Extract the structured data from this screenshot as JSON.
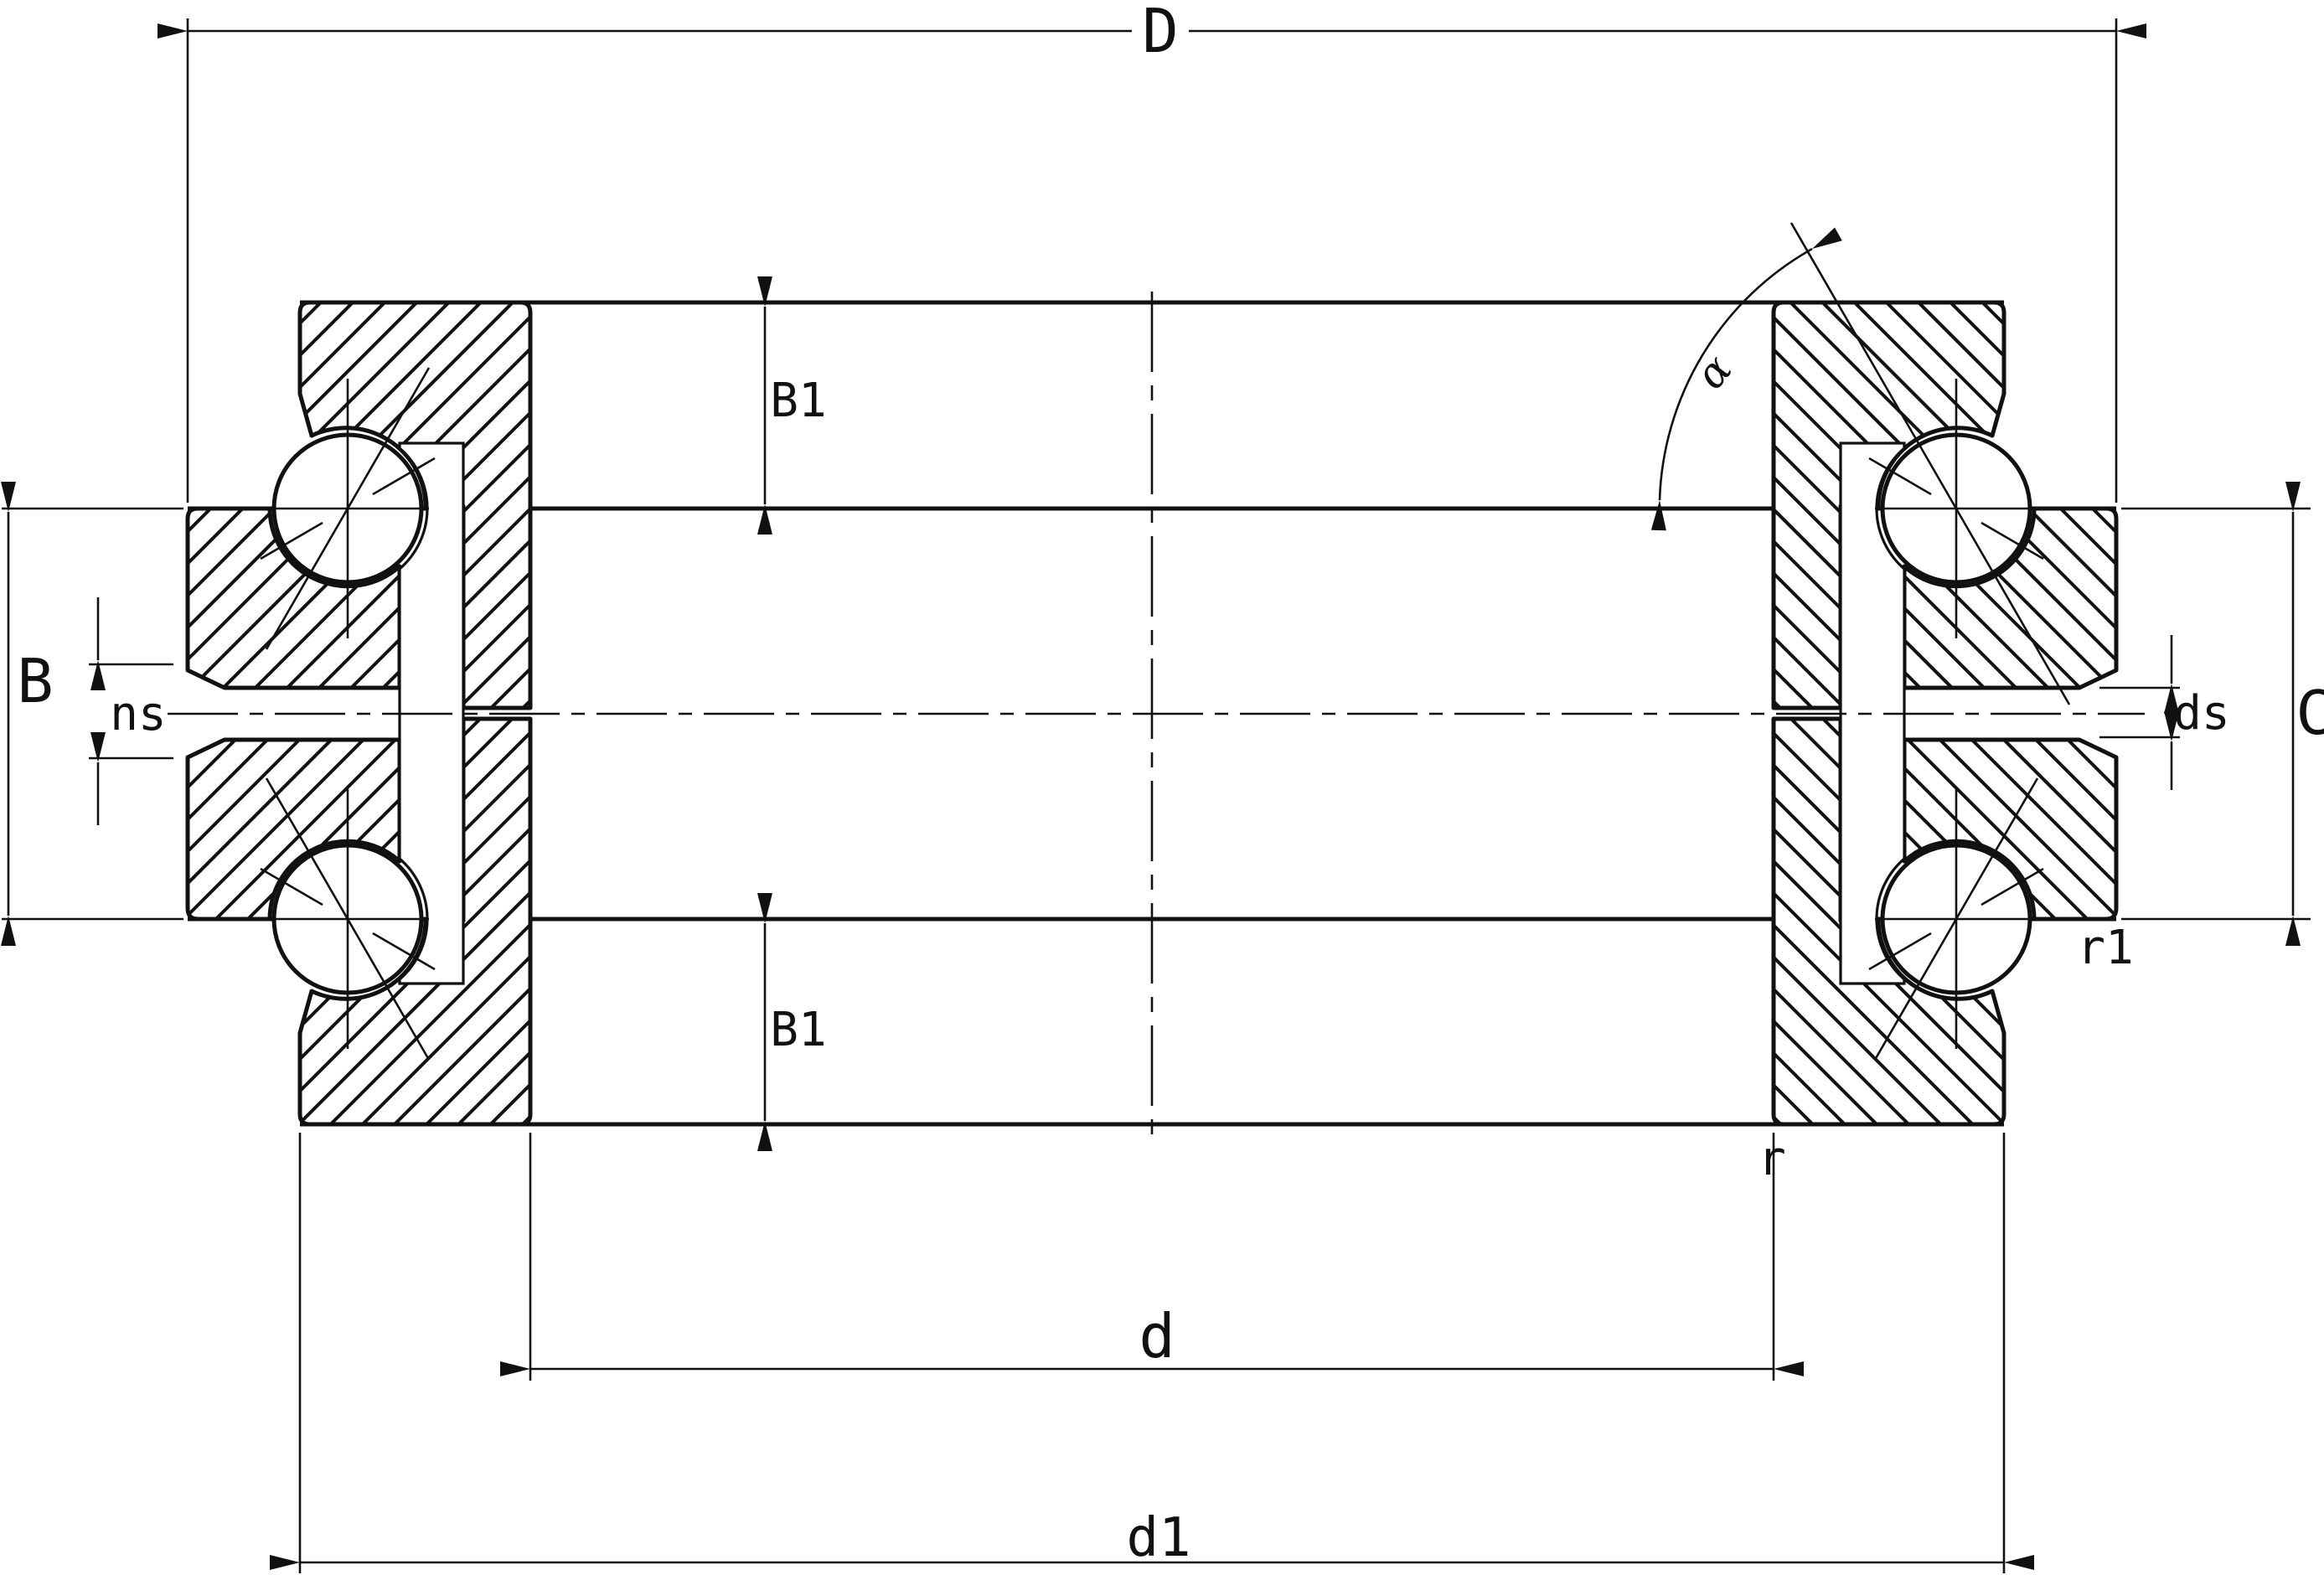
{
  "figure": {
    "kind": "technical drawing — double direction angular contact thrust ball bearing cross-section",
    "background_color": "#ffffff",
    "line_color": "#111111",
    "labels": {
      "outer_diameter": "D",
      "overall_width": "B",
      "locating_slot_width": "ns",
      "washer_width_top": "B1",
      "washer_width_bottom": "B1",
      "bore_diameter": "d",
      "intermediate_diameter": "d1",
      "pin_hole_diameter": "ds",
      "housing_washer_height": "C",
      "corner_radius": "r",
      "corner_radius_outer": "r1",
      "contact_angle": "α"
    }
  }
}
